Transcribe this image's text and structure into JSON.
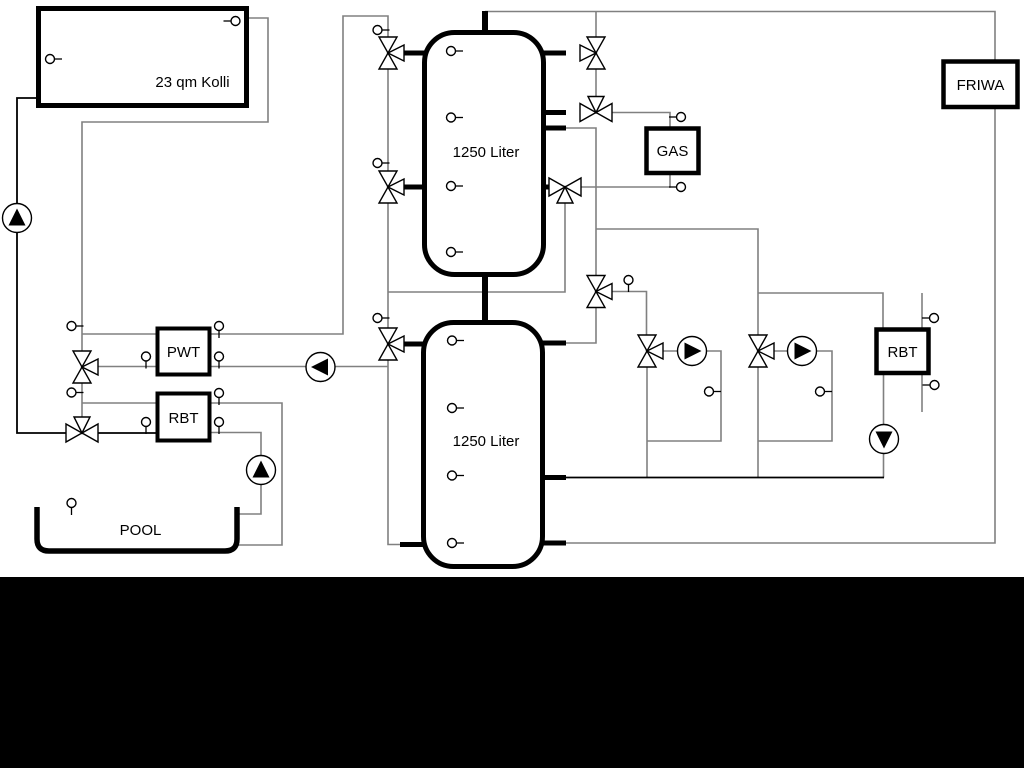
{
  "components": {
    "collector": {
      "label": "23 qm Kolli"
    },
    "tank_top": {
      "label": "1250 Liter"
    },
    "tank_bottom": {
      "label": "1250 Liter"
    },
    "pwt": {
      "label": "PWT"
    },
    "rbt_left": {
      "label": "RBT"
    },
    "gas": {
      "label": "GAS"
    },
    "rbt_right": {
      "label": "RBT"
    },
    "friwa": {
      "label": "FRIWA"
    },
    "pool": {
      "label": "POOL"
    }
  },
  "colors": {
    "pipe_gray": "#808080",
    "pipe_black": "#000000",
    "canvas_bg": "#ffffff",
    "bottom_bar": "#000000",
    "component_fill": "#ffffff",
    "symbol_fill": "#ffffff",
    "symbol_stroke": "#000000"
  },
  "icons": {
    "pump_icon": "circle-with-filled-triangle",
    "three_way_valve_icon": "bowtie-triangles-with-branch",
    "temp_sensor_icon": "small-circle-with-stem"
  }
}
